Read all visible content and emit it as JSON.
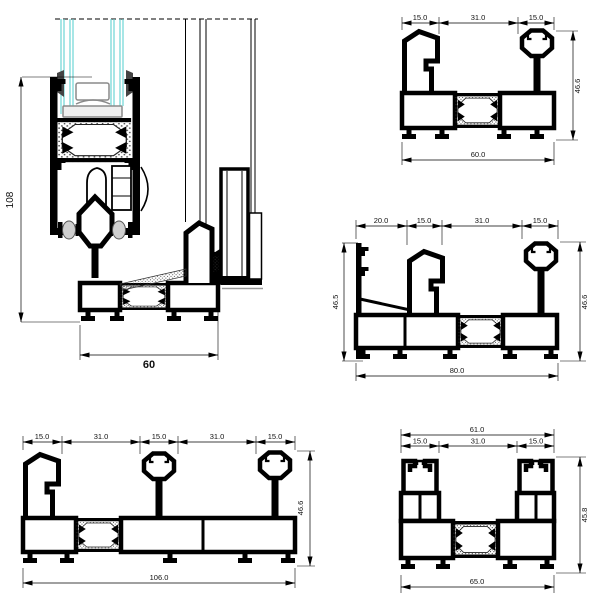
{
  "drawing": {
    "section_vertical": {
      "height_label": "108",
      "width_label": "60"
    },
    "profile60": {
      "top_dims": [
        "15.0",
        "31.0",
        "15.0"
      ],
      "right_dim": "46.6",
      "bottom_dim": "60.0"
    },
    "profile80": {
      "top_dims": [
        "20.0",
        "15.0",
        "31.0",
        "15.0"
      ],
      "left_dim": "46.5",
      "right_dim": "46.6",
      "bottom_dim": "80.0"
    },
    "profile106": {
      "top_dims": [
        "15.0",
        "31.0",
        "15.0",
        "31.0",
        "15.0"
      ],
      "right_dim": "46.6",
      "bottom_dim": "106.0"
    },
    "profile65": {
      "overall_dim": "61.0",
      "top_dims": [
        "15.0",
        "31.0",
        "15.0"
      ],
      "right_dim": "45.8",
      "bottom_dim": "65.0"
    }
  },
  "colors": {
    "line": "#000000",
    "glass": "#5fd0d0",
    "hatch": "#333333",
    "dim_text": "#111111",
    "gray": "#8a8a8a"
  }
}
